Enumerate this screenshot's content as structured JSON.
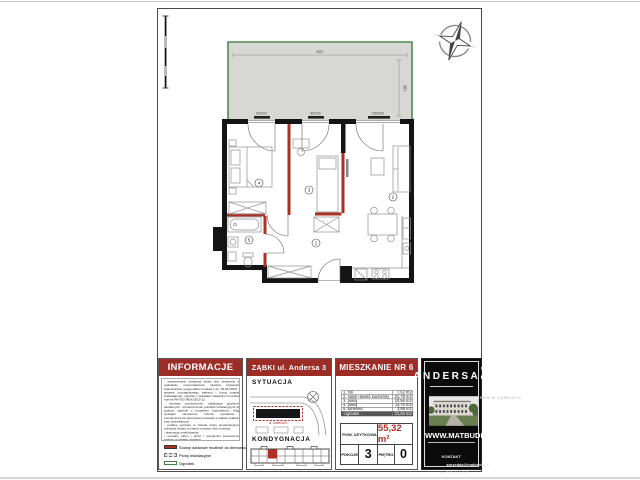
{
  "plan": {
    "dim_width": "621",
    "dim_height": "381",
    "window_labels": [
      "90/220",
      "90/220",
      "150/220"
    ],
    "room_numbers": [
      "1",
      "2",
      "3",
      "4",
      "5"
    ]
  },
  "panels": {
    "informacje": {
      "title": "INFORMACJE",
      "body": "- powierzchnia użytkowa lokalu jest określona na podstawie rozporządzenia ministra transportu, budownictwa i gospodarki morskiej z dn. 25.04.2012r. w sprawie szczegółowego zakresu i formy projektu budowlanego, zgodnie z zasadami zawartymi w polskiej normie PN-ISO 9836:2015-12\n- wymiary pomieszczeń, lokalizacja przyborów sanitarnych, rozmieszczenie punktów instalacyjnych itp. podano zgodnie z projektem budowlanym. Mogą wystąpić nieznaczne różnice wymiarów i rozmieszczenia elementów powstałe w trakcie realizacji prac budowlanych\n- podane wymiary w świetle ścian konstrukcyjnych przegród (ścian) w stanie surowym (bez tynków)\n- aranżacja umeblowania\n- wymiary okien i drzwi / wysokości pomieszczeń podano w świetle ościeżnic",
      "legend": [
        {
          "label": "Ściany działowe możliwe do demontażu"
        },
        {
          "label": "Piony instalacyjne"
        },
        {
          "label": "Ogródek"
        }
      ]
    },
    "lokalizacja": {
      "title": "ZĄBKI ul. Andersa 3",
      "sytuacja_label": "SYTUACJA",
      "kondygnacja_label": "KONDYGNACJA",
      "street_label": "ul. Andersa 3"
    },
    "mieszkanie": {
      "title": "MIESZKANIE NR 6",
      "rooms": [
        {
          "name": "1. hol",
          "area": "7,62 m2"
        },
        {
          "name": "2. salon+aneks kuchenny",
          "area": "21,78 m2"
        },
        {
          "name": "3. pokój",
          "area": "10,56 m2"
        },
        {
          "name": "4. pokój",
          "area": "11,70 m2"
        },
        {
          "name": "5. łazienka",
          "area": "3,66 m2"
        },
        {
          "name": "-ogródek",
          "area": "21,84 m2"
        }
      ],
      "pow_label": "POW. UŻYTKOWA",
      "pow_value": "55,32 m²",
      "pokoje_label": "POKOJE",
      "pokoje_value": "3",
      "pietro_label": "PIĘTRO",
      "pietro_value": "0"
    },
    "brand": {
      "logo_text": "ANDERSA",
      "logo_number": "3",
      "tagline": "NOWY ADRES W ZĄBKACH",
      "website": "WWW.MATBUDD.PL",
      "contact_label": "KONTAKT",
      "email": "sprzedaz@matbudd.pl",
      "phone": "tel: 793-444-866"
    },
    "colors": {
      "header_red": "#9b2d26",
      "partition_red": "#a93226",
      "garden_green": "#4e8b4e",
      "area_red": "#b02e25"
    }
  }
}
